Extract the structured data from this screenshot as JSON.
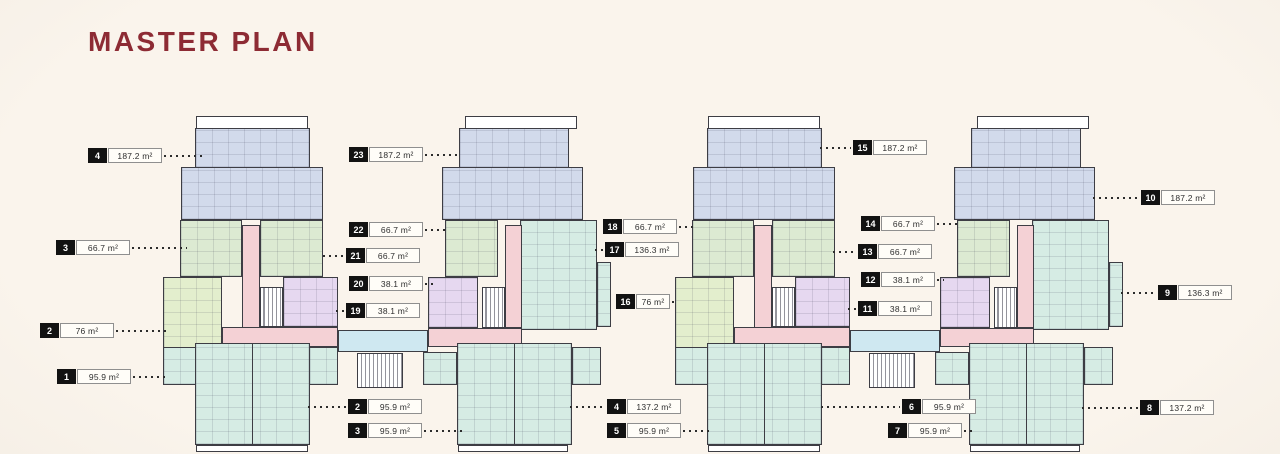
{
  "page": {
    "title": "MASTER PLAN"
  },
  "colors": {
    "background": "#faf4ec",
    "background_edge": "#f0e9de",
    "title": "#8d2b34",
    "wall": "#3d3d44",
    "plan_white": "#ffffff",
    "unit_blue": "#d2daeb",
    "unit_green": "#dcead2",
    "unit_lime": "#e3eecd",
    "unit_purple": "#e6d8f0",
    "unit_mint": "#d6ece4",
    "corridor_pink": "#f4d1d5",
    "link_blue": "#cfe8f1",
    "badge_bg": "#121212",
    "badge_text": "#ffffff",
    "label_box_bg": "#fffdf8",
    "label_box_border": "#8f8f8f",
    "dots": "#2c2c2c",
    "area_text": "#2f2f2f"
  },
  "unit_labels": [
    {
      "unit": "4",
      "area": "187.2 m²",
      "x": 88,
      "y": 156,
      "side": "right",
      "len": 38
    },
    {
      "unit": "3",
      "area": "66.7 m²",
      "x": 56,
      "y": 248,
      "side": "right",
      "len": 55
    },
    {
      "unit": "2",
      "area": "76 m²",
      "x": 40,
      "y": 331,
      "side": "right",
      "len": 52
    },
    {
      "unit": "1",
      "area": "95.9 m²",
      "x": 57,
      "y": 377,
      "side": "right",
      "len": 35
    },
    {
      "unit": "23",
      "area": "187.2 m²",
      "x": 349,
      "y": 155,
      "side": "right",
      "len": 36
    },
    {
      "unit": "22",
      "area": "66.7 m²",
      "x": 349,
      "y": 230,
      "side": "right",
      "len": 24
    },
    {
      "unit": "21",
      "area": "66.7 m²",
      "x": 346,
      "y": 256,
      "side": "left",
      "len": 21
    },
    {
      "unit": "20",
      "area": "38.1 m²",
      "x": 349,
      "y": 284,
      "side": "right",
      "len": 9
    },
    {
      "unit": "19",
      "area": "38.1 m²",
      "x": 346,
      "y": 311,
      "side": "left",
      "len": 8
    },
    {
      "unit": "18",
      "area": "66.7 m²",
      "x": 603,
      "y": 227,
      "side": "right",
      "len": 15
    },
    {
      "unit": "17",
      "area": "136.3 m²",
      "x": 605,
      "y": 250,
      "side": "left",
      "len": 8
    },
    {
      "unit": "16",
      "area": "76 m²",
      "x": 616,
      "y": 302,
      "side": "right",
      "len": 6,
      "w": 34
    },
    {
      "unit": "15",
      "area": "187.2 m²",
      "x": 853,
      "y": 148,
      "side": "left",
      "len": 31
    },
    {
      "unit": "14",
      "area": "66.7 m²",
      "x": 861,
      "y": 224,
      "side": "right",
      "len": 22
    },
    {
      "unit": "13",
      "area": "66.7 m²",
      "x": 858,
      "y": 252,
      "side": "left",
      "len": 23
    },
    {
      "unit": "12",
      "area": "38.1 m²",
      "x": 861,
      "y": 280,
      "side": "right",
      "len": 7
    },
    {
      "unit": "11",
      "area": "38.1 m²",
      "x": 858,
      "y": 309,
      "side": "left",
      "len": 8
    },
    {
      "unit": "10",
      "area": "187.2 m²",
      "x": 1141,
      "y": 198,
      "side": "left",
      "len": 46
    },
    {
      "unit": "9",
      "area": "136.3 m²",
      "x": 1158,
      "y": 293,
      "side": "left",
      "len": 35
    },
    {
      "unit": "8",
      "area": "137.2 m²",
      "x": 1140,
      "y": 408,
      "side": "left",
      "len": 56
    },
    {
      "unit": "2",
      "area": "95.9 m²",
      "x": 348,
      "y": 407,
      "side": "left",
      "len": 38
    },
    {
      "unit": "3",
      "area": "95.9 m²",
      "x": 348,
      "y": 431,
      "side": "right",
      "len": 39
    },
    {
      "unit": "4",
      "area": "137.2 m²",
      "x": 607,
      "y": 407,
      "side": "left",
      "len": 35
    },
    {
      "unit": "5",
      "area": "95.9 m²",
      "x": 607,
      "y": 431,
      "side": "right",
      "len": 28
    },
    {
      "unit": "6",
      "area": "95.9 m²",
      "x": 902,
      "y": 407,
      "side": "left",
      "len": 79
    },
    {
      "unit": "7",
      "area": "95.9 m²",
      "x": 888,
      "y": 431,
      "side": "right",
      "len": 8
    }
  ]
}
